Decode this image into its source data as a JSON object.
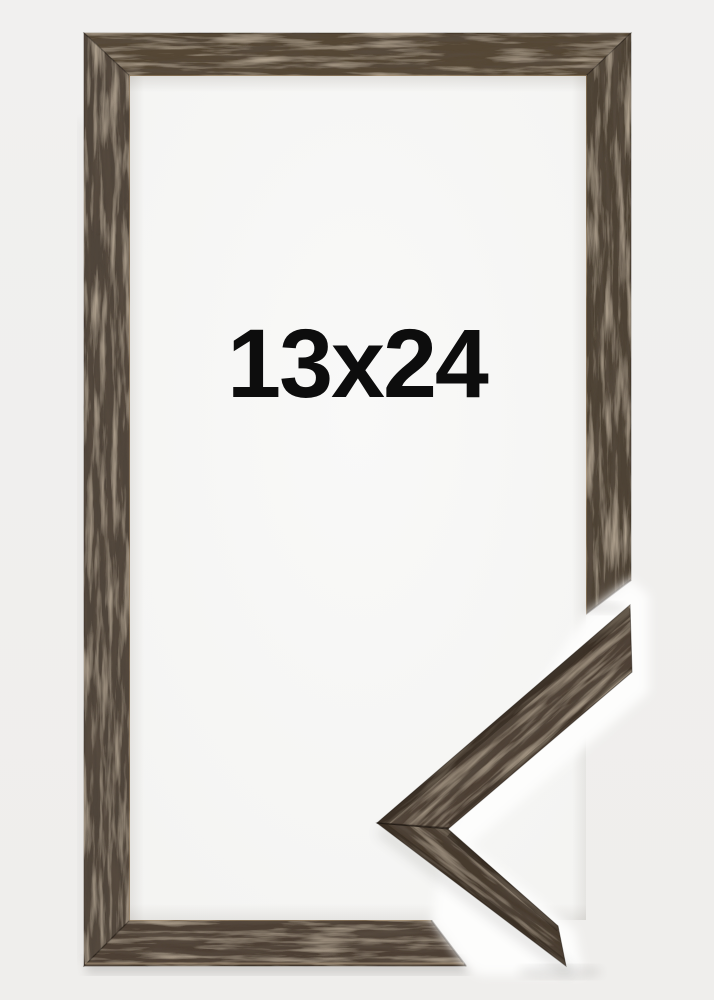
{
  "frame_product": {
    "size_label": "13x24",
    "label_color": "#0d0d0d",
    "wood_color": "#4f4336",
    "wood_color_dark": "#2b2117",
    "wood_color_light": "#8d7354",
    "paper_color": "#f8f8f6",
    "background_color": "#f0efed",
    "overlay_outline_color": "#fdfdfc"
  }
}
